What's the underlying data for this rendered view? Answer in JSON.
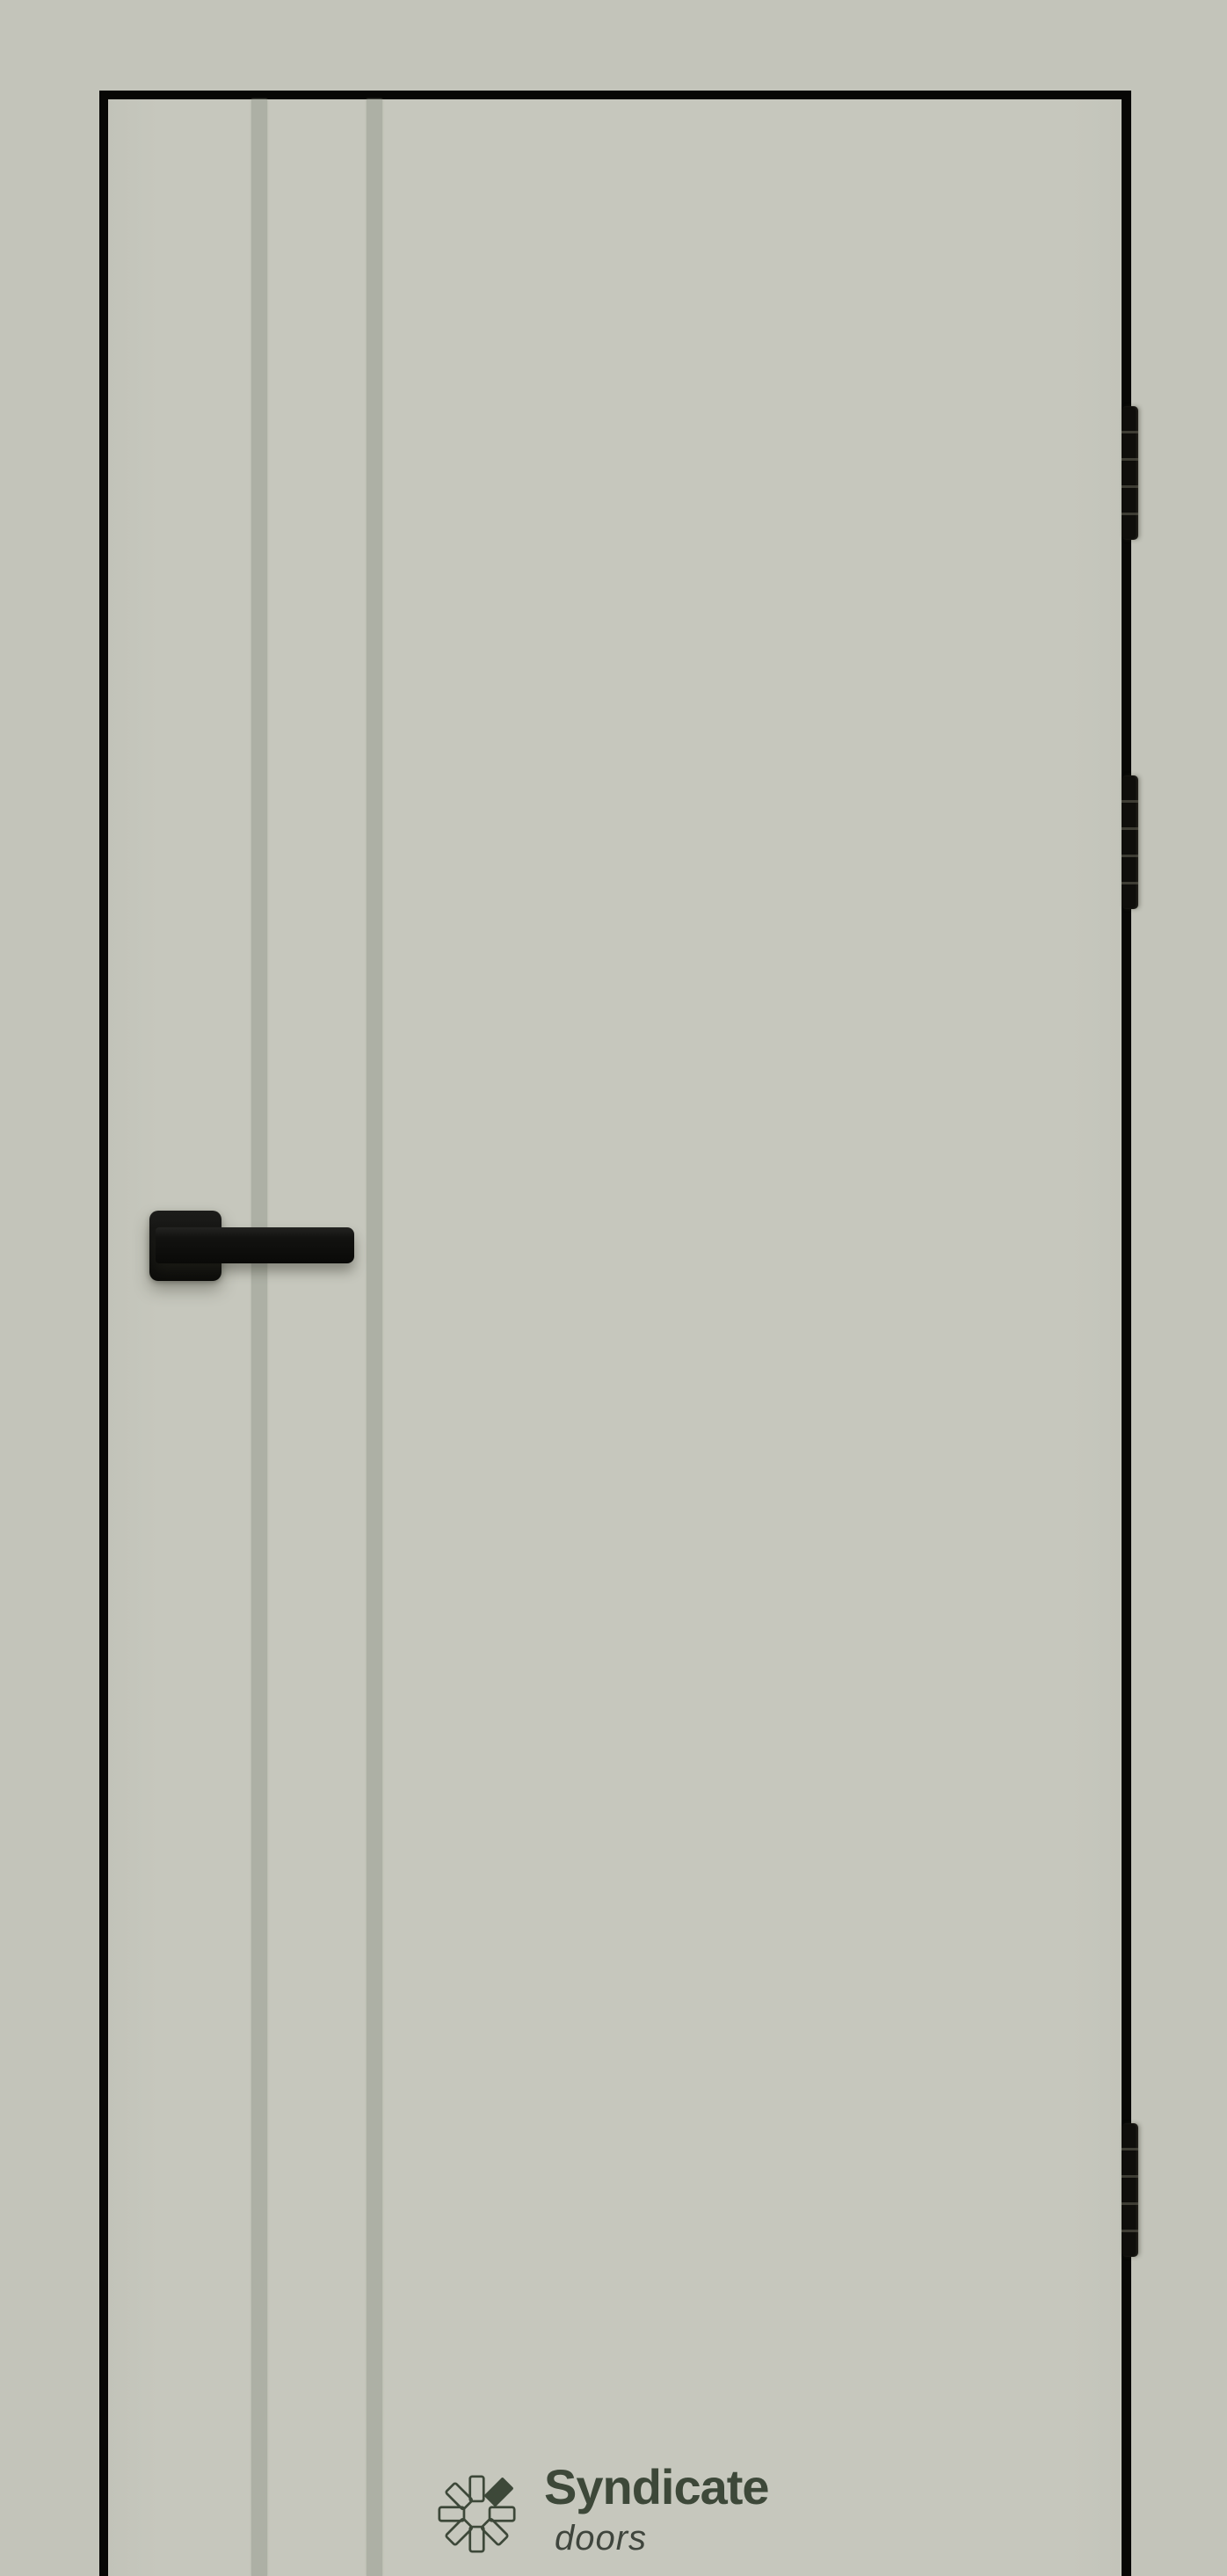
{
  "colors": {
    "background": "#c3c4ba",
    "door-panel": "#c6c7bd",
    "door-stripe": "#adb0a5",
    "door-frame": "#070705",
    "hardware": "#131311",
    "brand": "#3d4839",
    "brand-tagline": "#3f453d"
  },
  "door": {
    "stripe_count": 2,
    "hinge_count": 3,
    "handle_side": "left",
    "hinge_side": "right"
  },
  "brand": {
    "logo_icon": "pinwheel-petals-icon",
    "name": "Syndicate",
    "tagline": "doors"
  }
}
